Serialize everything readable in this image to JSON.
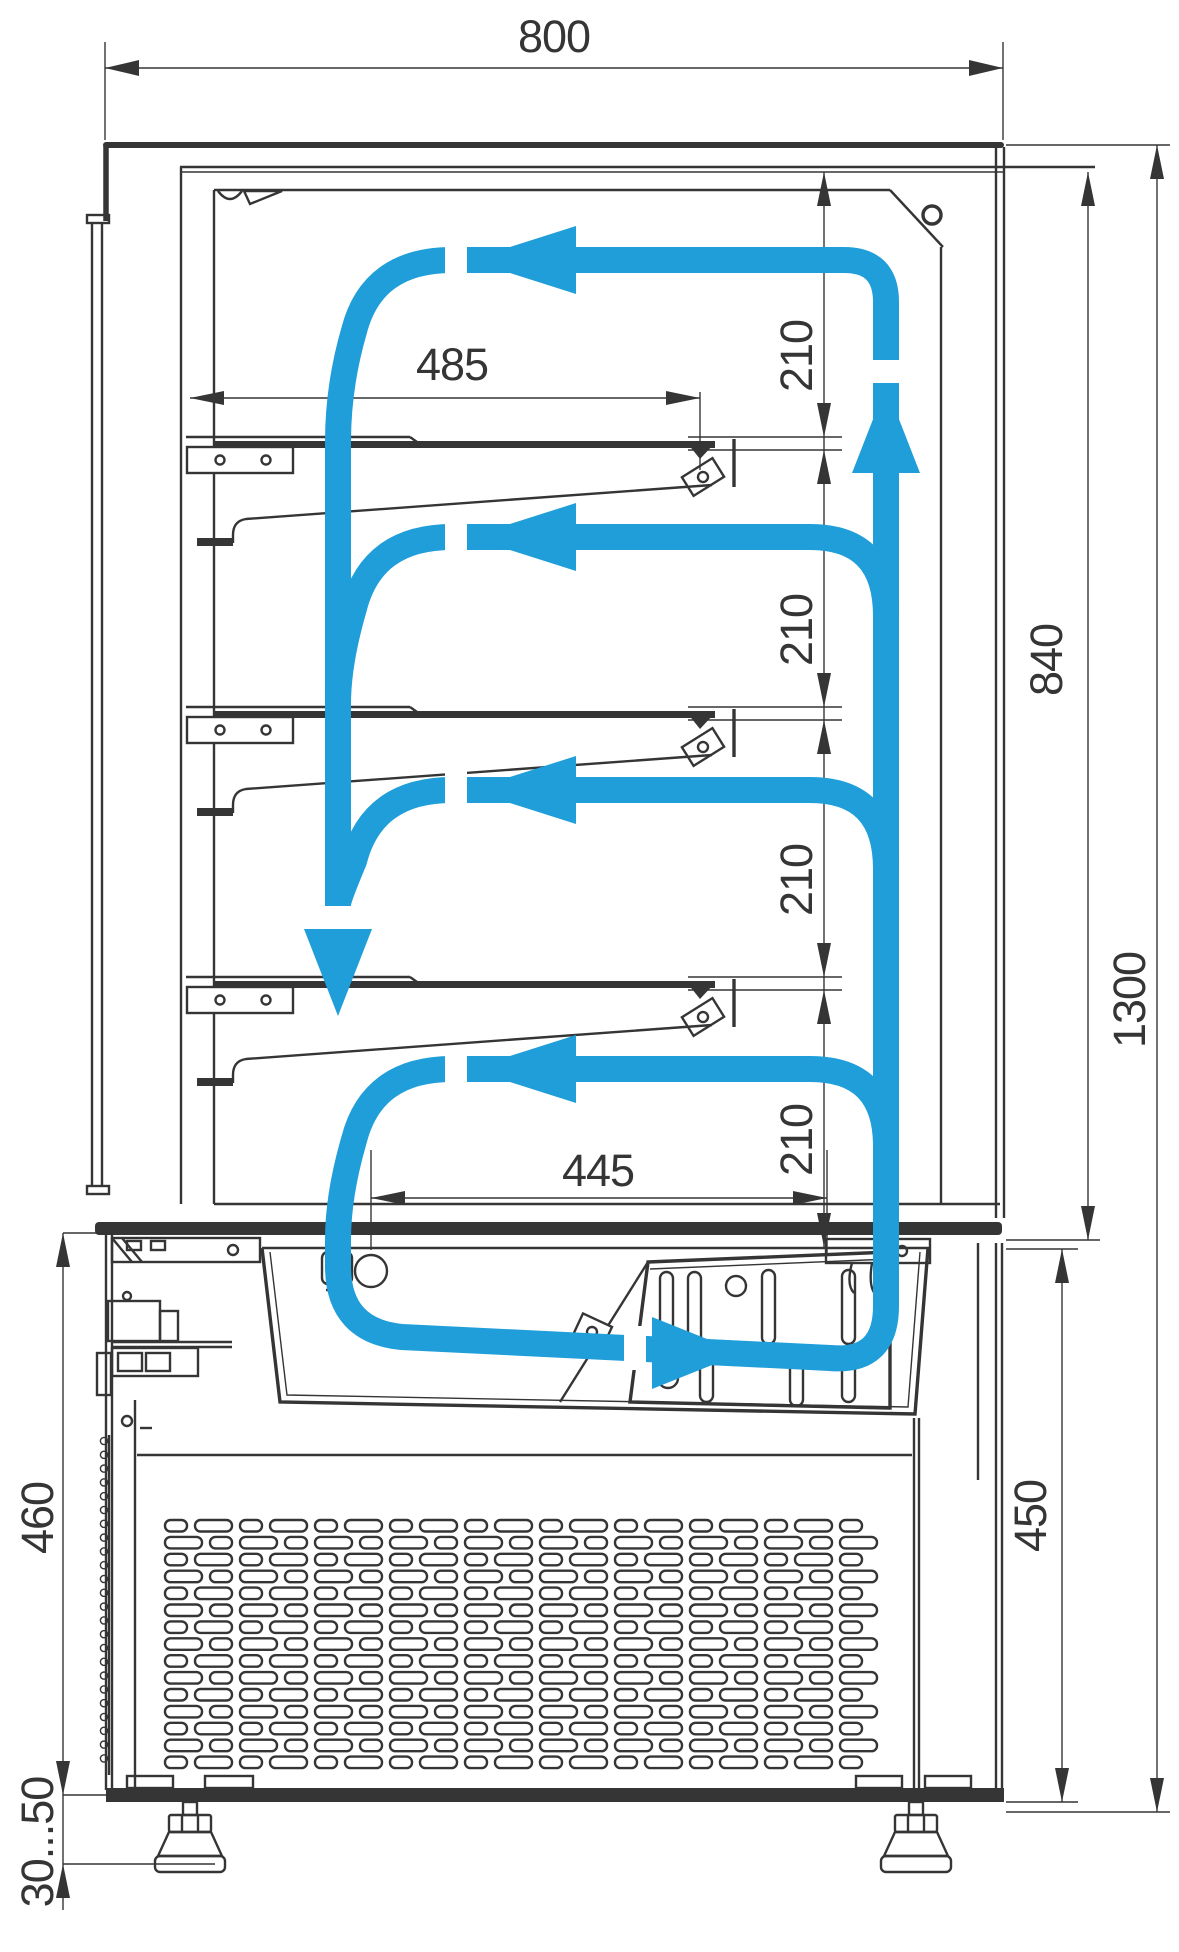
{
  "title": "Refrigerated display case — airflow and dimensions diagram",
  "units": "mm",
  "dimensions": {
    "overall_width": "800",
    "shelf_length": "485",
    "base_well_width": "445",
    "shelf_air_gaps": [
      "210",
      "210",
      "210",
      "210"
    ],
    "display_section_height": "840",
    "overall_height": "1300",
    "base_height_right": "450",
    "base_height_left": "460",
    "adjustable_feet_range": "30...50"
  },
  "colors": {
    "airflow": "#1f9ed9",
    "line": "#353535"
  },
  "legend": {
    "airflow_meaning": "cold air circulation loop"
  }
}
